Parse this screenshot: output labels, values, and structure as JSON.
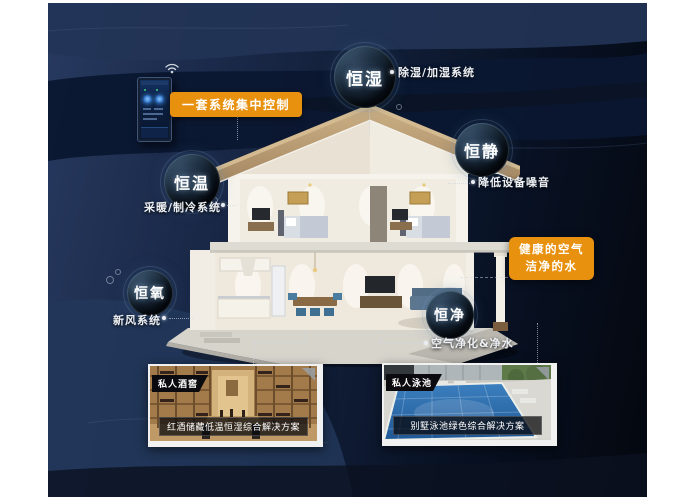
{
  "colors": {
    "accent_orange": "#e8910f",
    "canvas_navy": "#273a60",
    "canvas_black": "#04070e",
    "note_text": "#eef1f5"
  },
  "control": {
    "label": "一套系统集中控制"
  },
  "bubbles": [
    {
      "label": "恒湿",
      "note": "除湿/加湿系统"
    },
    {
      "label": "恒静",
      "note": "降低设备噪音"
    },
    {
      "label": "恒温",
      "note": "采暖/制冷系统"
    },
    {
      "label": "恒氧",
      "note": "新风系统"
    },
    {
      "label": "恒净",
      "note": "空气净化&净水"
    }
  ],
  "highlight": {
    "line1": "健康的空气",
    "line2": "洁净的水"
  },
  "cards": [
    {
      "tag": "私人酒窖",
      "caption": "红酒储藏低温恒湿综合解决方案"
    },
    {
      "tag": "私人泳池",
      "caption": "别墅泳池绿色综合解决方案"
    }
  ]
}
